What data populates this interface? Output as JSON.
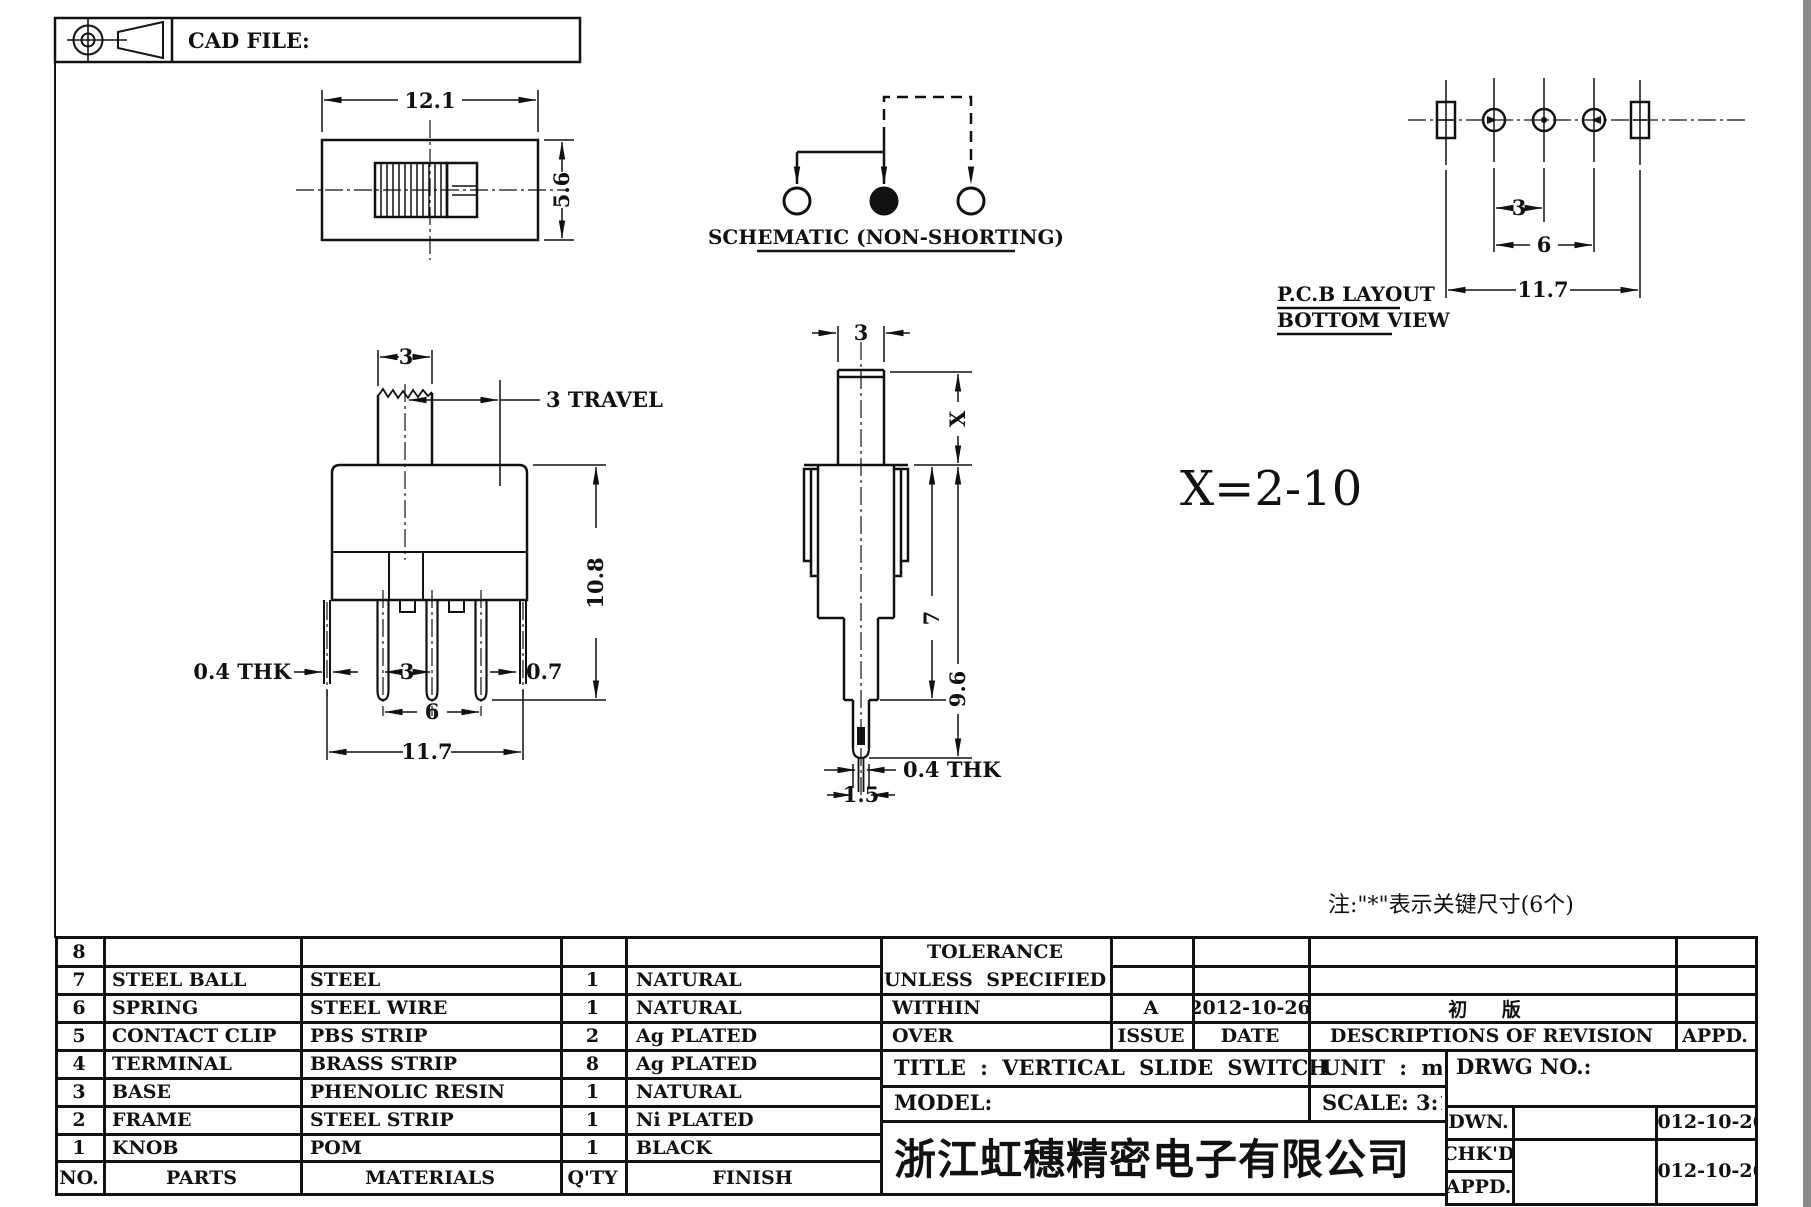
{
  "header": {
    "cad_file": "CAD FILE:"
  },
  "drawing": {
    "top_view": {
      "width": "12.1",
      "height": "5.6"
    },
    "schematic": {
      "caption": "SCHEMATIC (NON-SHORTING)"
    },
    "pcb": {
      "pitch": "3",
      "span": "6",
      "total": "11.7",
      "title": "P.C.B LAYOUT",
      "subtitle": "BOTTOM VIEW"
    },
    "front": {
      "knob_width": "3",
      "travel_label": "3 TRAVEL",
      "height": "10.8",
      "thk_label": "0.4 THK",
      "pitch": "3",
      "span": "6",
      "total": "11.7",
      "edge": "0.7"
    },
    "side": {
      "knob_width": "3",
      "x_label": "X",
      "body_depth": "7",
      "height": "9.6",
      "thk_label": "0.4 THK",
      "tip_width": "1.5",
      "x_range": "X=2-10"
    },
    "note": "注:\"*\"表示关键尺寸(6个)"
  },
  "parts": {
    "header": {
      "no": "NO.",
      "parts": "PARTS",
      "materials": "MATERIALS",
      "qty": "Q'TY",
      "finish": "FINISH"
    },
    "rows": [
      {
        "no": "8",
        "parts": "",
        "materials": "",
        "qty": "",
        "finish": ""
      },
      {
        "no": "7",
        "parts": "STEEL BALL",
        "materials": "STEEL",
        "qty": "1",
        "finish": "NATURAL"
      },
      {
        "no": "6",
        "parts": "SPRING",
        "materials": "STEEL WIRE",
        "qty": "1",
        "finish": "NATURAL"
      },
      {
        "no": "5",
        "parts": "CONTACT CLIP",
        "materials": "PBS STRIP",
        "qty": "2",
        "finish": "Ag PLATED"
      },
      {
        "no": "4",
        "parts": "TERMINAL",
        "materials": "BRASS STRIP",
        "qty": "8",
        "finish": "Ag PLATED"
      },
      {
        "no": "3",
        "parts": "BASE",
        "materials": "PHENOLIC RESIN",
        "qty": "1",
        "finish": "NATURAL"
      },
      {
        "no": "2",
        "parts": "FRAME",
        "materials": "STEEL STRIP",
        "qty": "1",
        "finish": "Ni PLATED"
      },
      {
        "no": "1",
        "parts": "KNOB",
        "materials": "POM",
        "qty": "1",
        "finish": "BLACK"
      }
    ]
  },
  "titleblock": {
    "tolerance_line1": "TOLERANCE",
    "tolerance_line2": "UNLESS SPECIFIED",
    "within": "WITHIN",
    "over": "OVER",
    "issue_value": "A",
    "issue_date": "2012-10-26",
    "revision_desc": "初 版",
    "issue_label": "ISSUE",
    "date_label": "DATE",
    "desc_label": "DESCRIPTIONS OF REVISION",
    "appd_label": "APPD.",
    "title": "TITLE :  VERTICAL SLIDE SWITCH",
    "unit": "UNIT :  mm",
    "drwg_no": "DRWG NO.:",
    "model": "MODEL:",
    "scale": "SCALE:  3:1",
    "company": "浙江虹穗精密电子有限公司",
    "dwn_label": "DWN.",
    "dwn_date": "2012-10-26",
    "chkd_label": "CHK'D",
    "appd2_label": "APPD.",
    "chkd_date": "2012-10-26"
  }
}
